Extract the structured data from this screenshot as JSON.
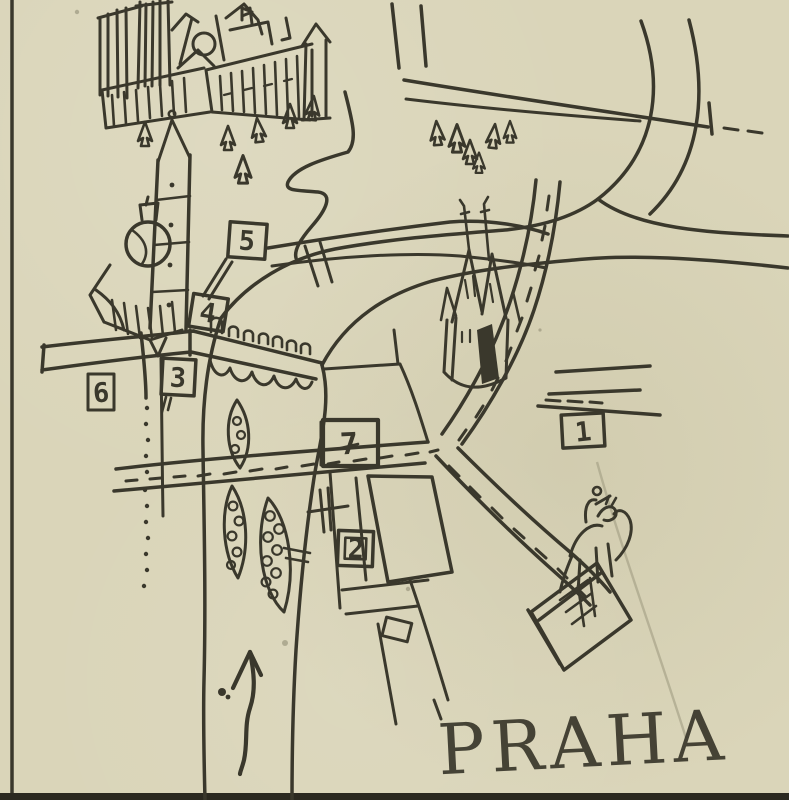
{
  "title": {
    "text": "PRAHA",
    "tick": "’"
  },
  "markers": [
    {
      "id": 1,
      "label": "1"
    },
    {
      "id": 2,
      "label": "2"
    },
    {
      "id": 3,
      "label": "3"
    },
    {
      "id": 4,
      "label": "4"
    },
    {
      "id": 5,
      "label": "5"
    },
    {
      "id": 6,
      "label": "6"
    },
    {
      "id": 7,
      "label": "7"
    }
  ],
  "colors": {
    "paper": "#dad5b9",
    "ink": "#3a382c",
    "ink_heavy": "#2b2920",
    "crease": "#a49f85",
    "speck": "#8b8670"
  },
  "icons": [
    "prague-castle-drawing",
    "cathedral-towers",
    "rose-window",
    "dome-church-drawing",
    "church-tower",
    "pine-tree-icon",
    "charles-bridge-drawing",
    "bridge-statues",
    "bridge-arches",
    "vltava-river-drawing",
    "river-island",
    "legion-bridge-drawing",
    "route-dashes",
    "tyn-church-drawing",
    "city-block",
    "equestrian-statue-drawing",
    "flow-arrow-icon",
    "marker-flag",
    "page-border-rule",
    "title-lettering"
  ]
}
